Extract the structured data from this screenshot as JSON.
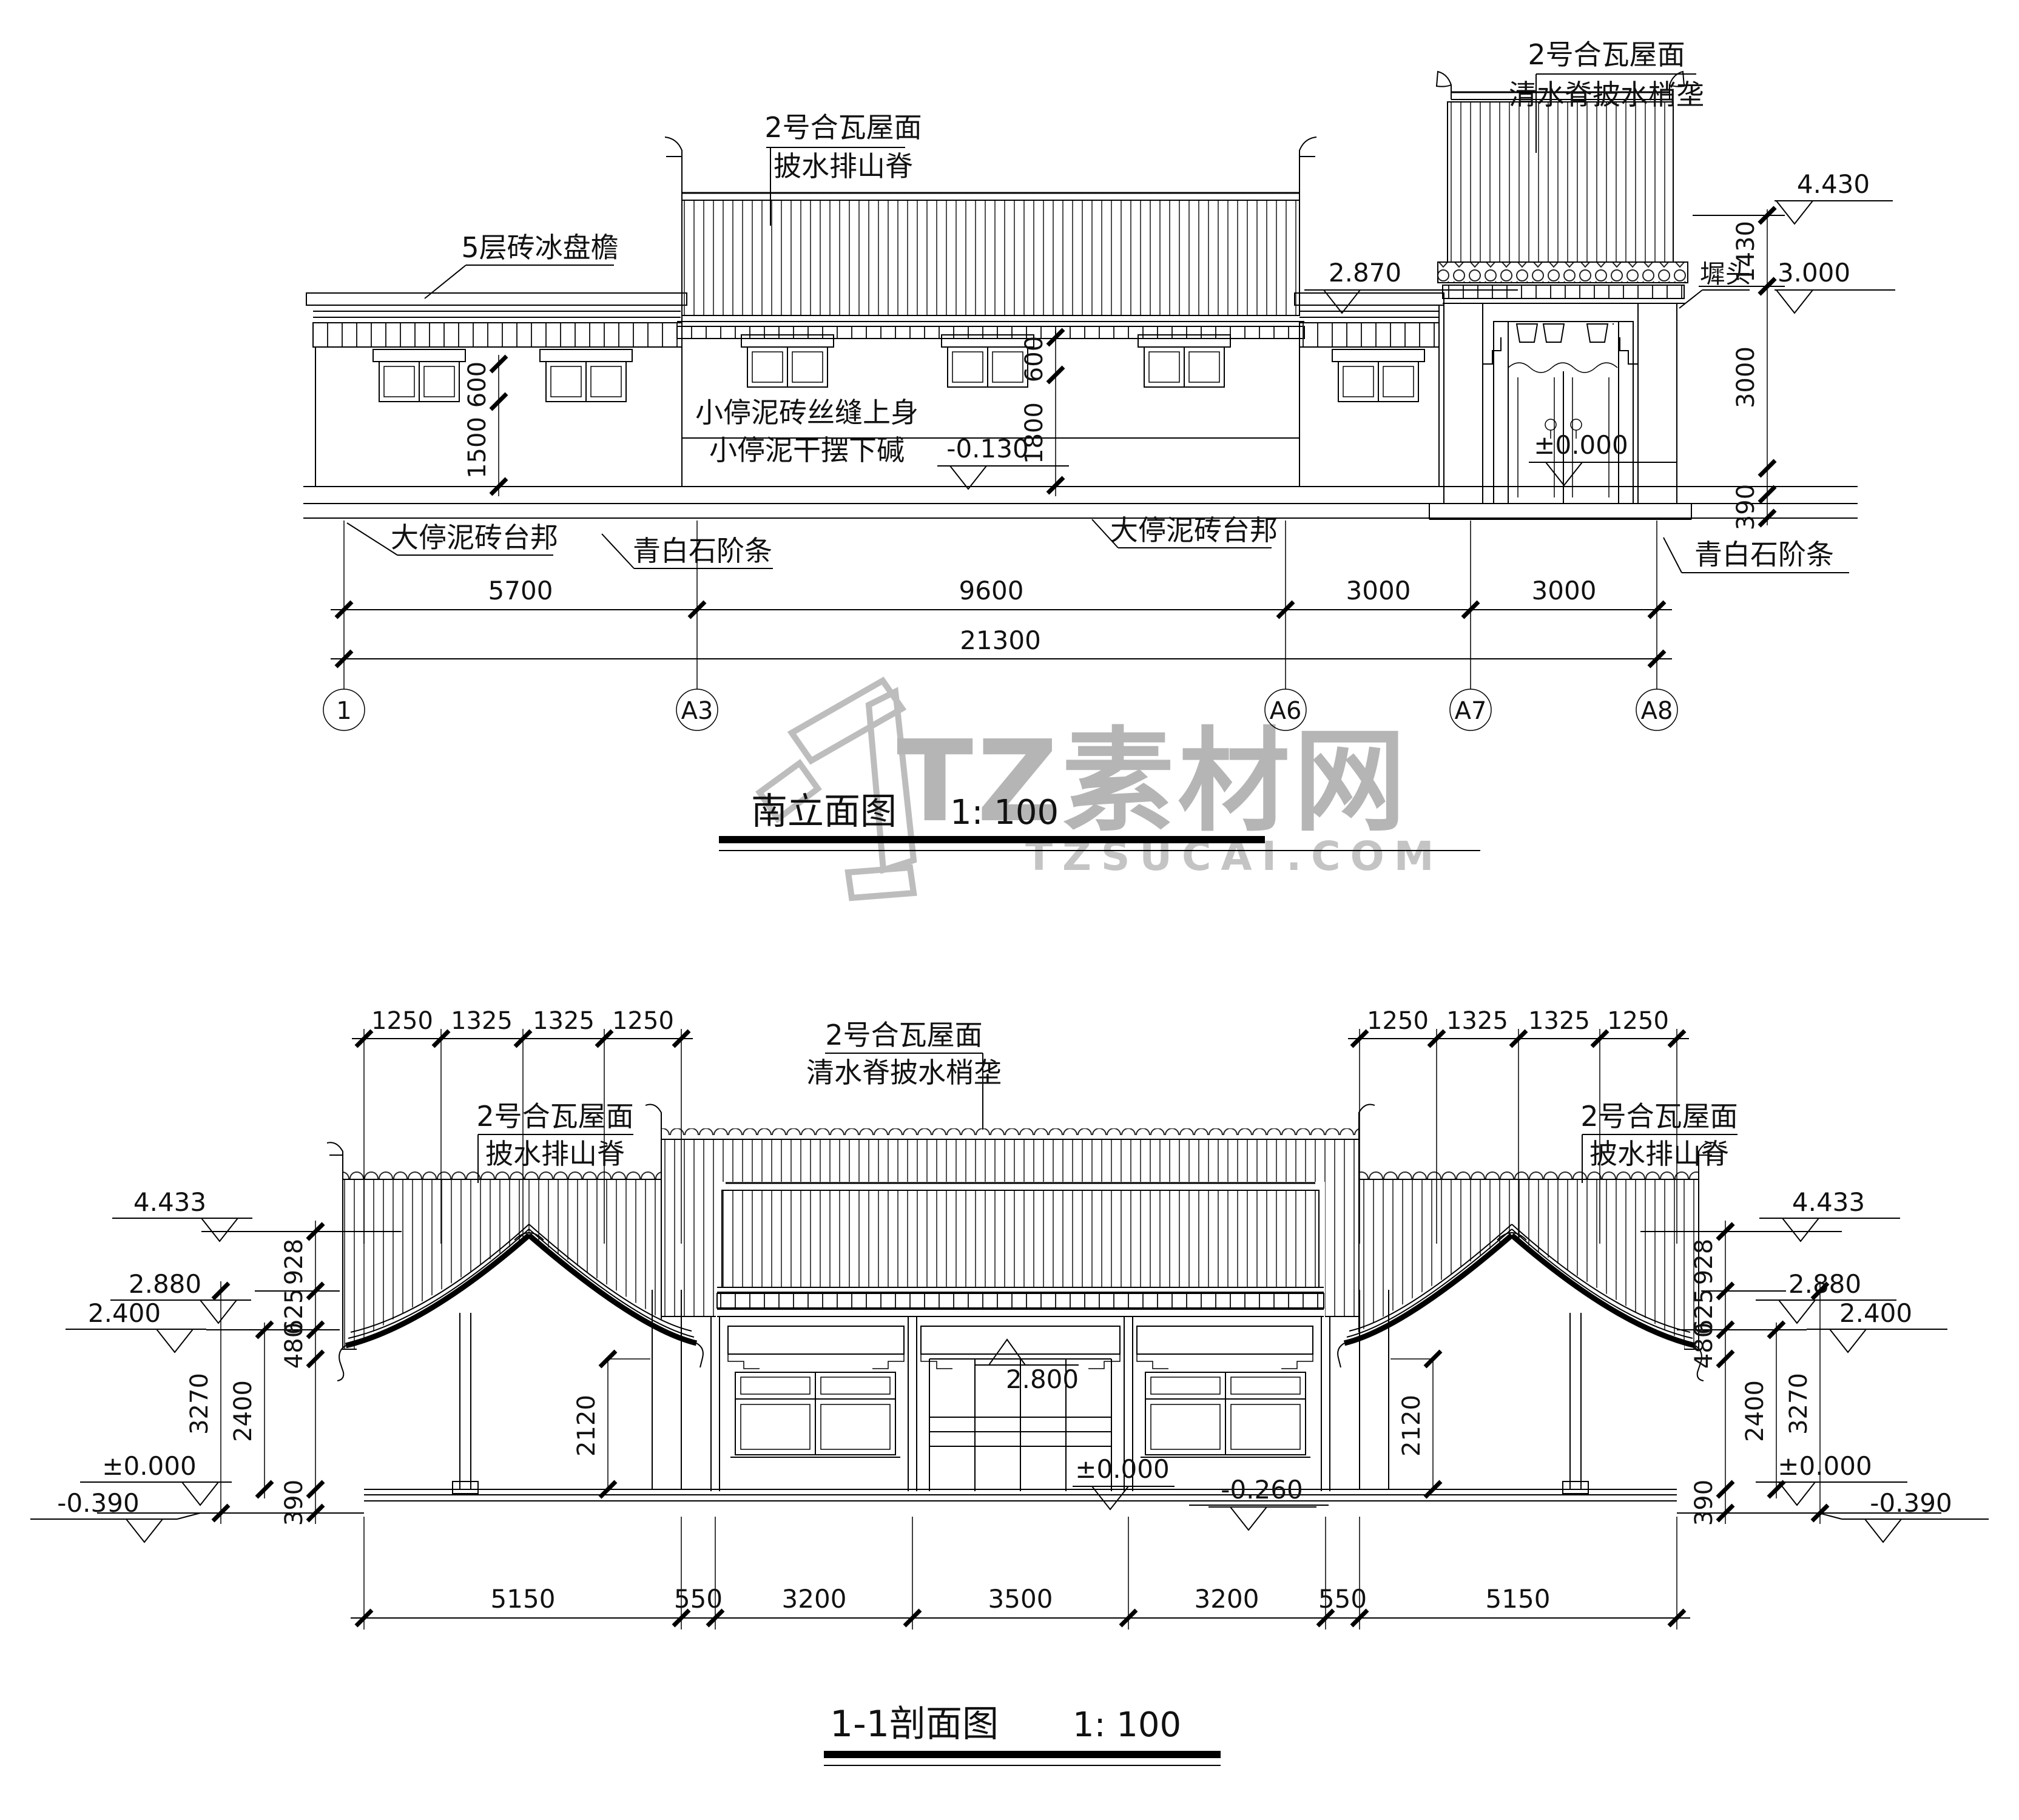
{
  "watermark": {
    "brand": "TZ素材网",
    "domain": "TZSUCAI.COM"
  },
  "elevation": {
    "title": "南立面图",
    "scale": "1: 100",
    "labels": {
      "roof_center_1": "2号合瓦屋面",
      "roof_center_2": "披水排山脊",
      "roof_gate_1": "2号合瓦屋面",
      "roof_gate_2": "清水脊披水梢垄",
      "cornice": "5层砖冰盘檐",
      "wall_upper": "小停泥砖丝缝上身",
      "wall_lower": "小停泥干摆下碱",
      "chitou": "墀头",
      "platform_left": "大停泥砖台邦",
      "stone_left": "青白石阶条",
      "platform_right": "大停泥砖台邦",
      "stone_right": "青白石阶条"
    },
    "levels": {
      "parapet": "2.870",
      "gate_top": "4.430",
      "gate_eave": "3.000",
      "gate_zero": "±0.000",
      "wall_base": "-0.130"
    },
    "vdims": {
      "win": "600",
      "wall_low": "1500",
      "mid_win": "600",
      "mid_wall": "1800",
      "gate_upper": "1430",
      "gate_body": "3000",
      "plinth": "390"
    },
    "dims": [
      "5700",
      "9600",
      "3000",
      "3000"
    ],
    "total": "21300",
    "grid": [
      "1",
      "A3",
      "A6",
      "A7",
      "A8"
    ]
  },
  "section": {
    "title": "1-1剖面图",
    "scale": "1: 100",
    "labels": {
      "left_1": "2号合瓦屋面",
      "left_2": "披水排山脊",
      "center_1": "2号合瓦屋面",
      "center_2": "清水脊披水梢垄",
      "right_1": "2号合瓦屋面",
      "right_2": "披水排山脊"
    },
    "levels_left": {
      "ridge": "4.433",
      "eave": "2.880",
      "porch": "2.400",
      "zero": "±0.000",
      "ground": "-0.390"
    },
    "levels_right": {
      "ridge": "4.433",
      "eave": "2.880",
      "porch": "2.400",
      "zero": "±0.000",
      "ground": "-0.390"
    },
    "levels_center": {
      "beam": "2.800",
      "zero": "±0.000",
      "court": "-0.260"
    },
    "vdims_left": {
      "a": "928",
      "b": "625",
      "c": "480",
      "d": "2400",
      "e": "3270",
      "f": "390",
      "inner": "2120"
    },
    "vdims_right": {
      "a": "928",
      "b": "625",
      "c": "480",
      "d": "2400",
      "e": "3270",
      "f": "390",
      "inner": "2120"
    },
    "dims_top_left": [
      "1250",
      "1325",
      "1325",
      "1250"
    ],
    "dims_top_right": [
      "1250",
      "1325",
      "1325",
      "1250"
    ],
    "dims_bottom": [
      "5150",
      "550",
      "3200",
      "3500",
      "3200",
      "550",
      "5150"
    ]
  }
}
